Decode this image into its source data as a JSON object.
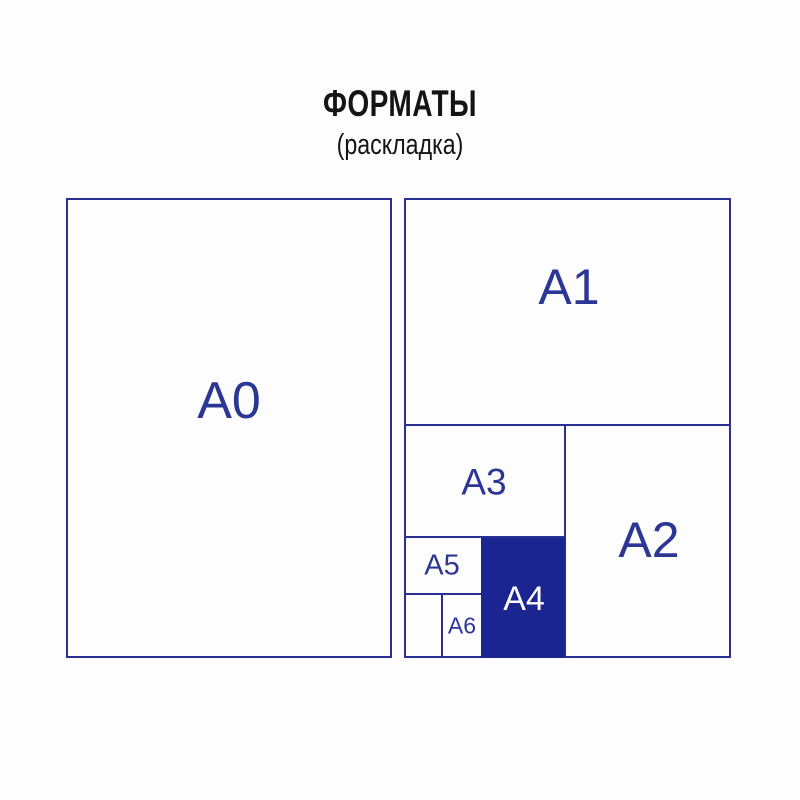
{
  "title": {
    "text": "ФОРМАТЫ",
    "subtitle": "(раскладка)"
  },
  "colors": {
    "background": "#fdfdfe",
    "outline": "#2a2f93",
    "label": "#2c3795",
    "title_text": "#141414",
    "a4_fill": "#1b2591",
    "a4_label": "#ffffff"
  },
  "formats": {
    "a0": {
      "label": "A0"
    },
    "a1": {
      "label": "A1"
    },
    "a2": {
      "label": "A2"
    },
    "a3": {
      "label": "A3"
    },
    "a4": {
      "label": "A4"
    },
    "a5": {
      "label": "A5"
    },
    "a6": {
      "label": "A6"
    }
  }
}
